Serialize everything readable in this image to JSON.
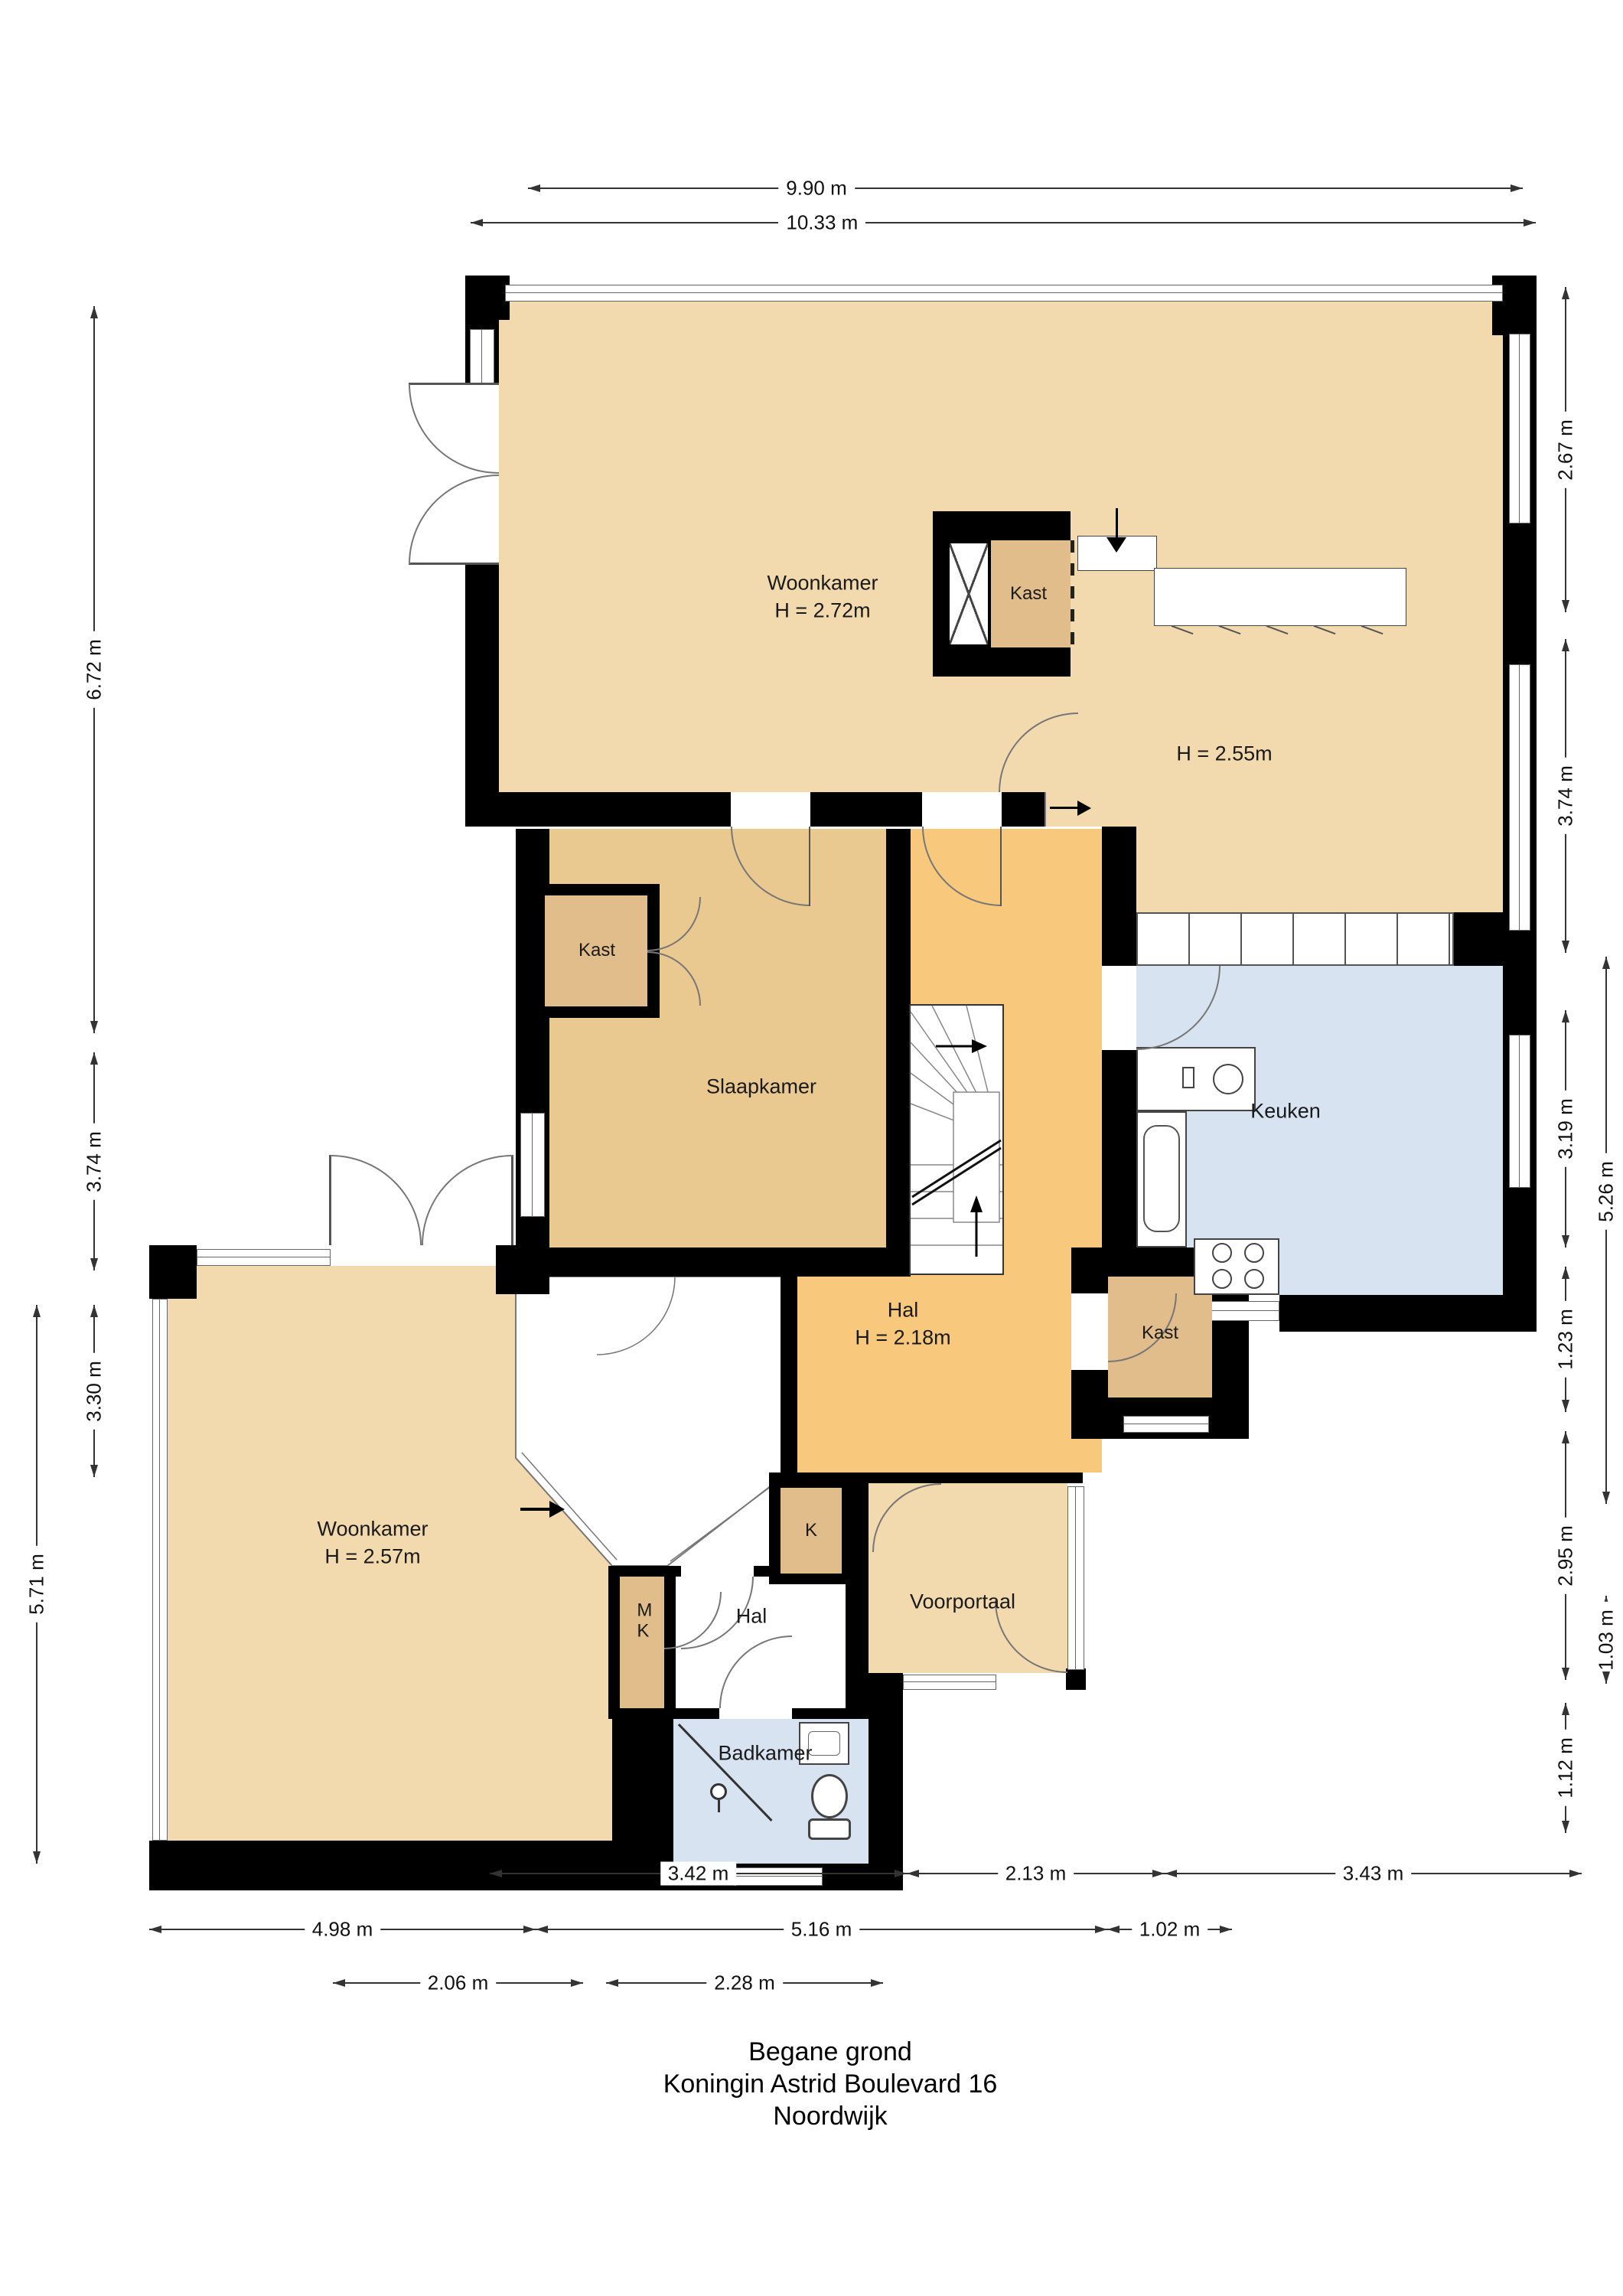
{
  "title": {
    "line1": "Begane grond",
    "line2": "Koningin Astrid Boulevard 16",
    "line3": "Noordwijk"
  },
  "rooms": {
    "woonkamer_boven": {
      "name": "Woonkamer",
      "height": "H = 2.72m"
    },
    "eetkamer": {
      "height": "H = 2.55m"
    },
    "kast_boven": {
      "name": "Kast"
    },
    "slaapkamer": {
      "name": "Slaapkamer"
    },
    "kast_slaapkamer": {
      "name": "Kast"
    },
    "keuken": {
      "name": "Keuken"
    },
    "hal": {
      "name": "Hal",
      "height": "H = 2.18m"
    },
    "kast_hal": {
      "name": "Kast"
    },
    "woonkamer_beneden": {
      "name": "Woonkamer",
      "height": "H = 2.57m"
    },
    "k_kast": {
      "name": "K"
    },
    "mk_kast": {
      "name": "MK"
    },
    "hal_klein": {
      "name": "Hal"
    },
    "voorportaal": {
      "name": "Voorportaal"
    },
    "badkamer": {
      "name": "Badkamer"
    }
  },
  "dimensions": {
    "top": [
      "9.90 m",
      "10.33 m"
    ],
    "left": [
      "6.72 m",
      "3.74 m",
      "3.30 m",
      "5.71 m"
    ],
    "right": [
      "2.67 m",
      "3.74 m",
      "3.19 m",
      "5.26 m",
      "1.23 m",
      "2.95 m",
      "1.03 m",
      "1.12 m"
    ],
    "bottom": [
      "3.42 m",
      "2.13 m",
      "3.43 m",
      "4.98 m",
      "5.16 m",
      "1.02 m",
      "2.06 m",
      "2.28 m"
    ]
  },
  "colors": {
    "wall": "#000000",
    "room_tan": "#F2DAAE",
    "slaapkamer_tan": "#E9C98F",
    "closet_tan": "#E0BD8B",
    "hal_orange": "#F8C97C",
    "wet_room_blue": "#D7E3F0",
    "dimension_line": "#333333"
  }
}
